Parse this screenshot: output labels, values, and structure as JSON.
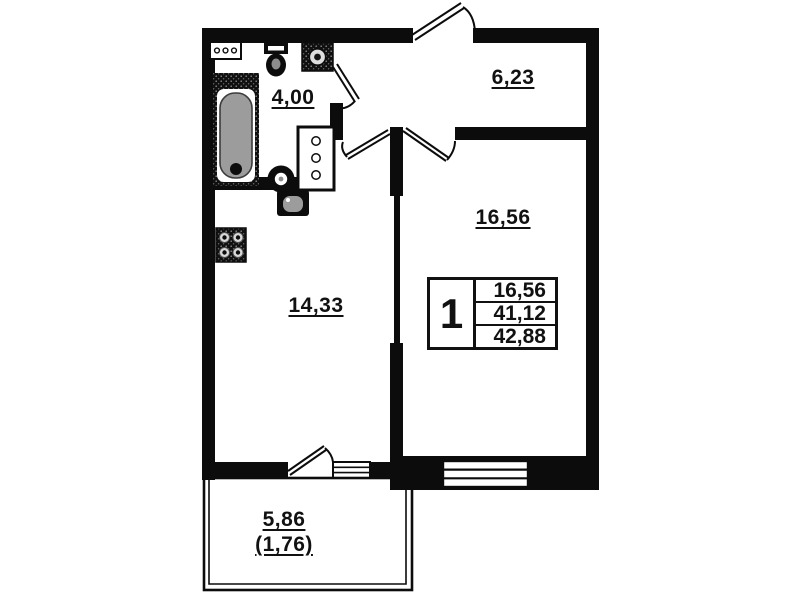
{
  "rooms": {
    "bathroom": {
      "label": "4,00"
    },
    "hallway": {
      "label": "6,23"
    },
    "living": {
      "label": "16,56"
    },
    "kitchen": {
      "label": "14,33"
    },
    "balcony": {
      "label": "5,86",
      "label_secondary": "(1,76)"
    }
  },
  "info_table": {
    "room_count": "1",
    "rows": [
      "16,56",
      "41,12",
      "42,88"
    ]
  },
  "fixtures": [
    "bathtub",
    "washbasin",
    "toilet",
    "washing-machine",
    "radiator",
    "ventilation-shaft",
    "kitchen-sink",
    "stove"
  ],
  "colors": {
    "wall": "#0c0c0c",
    "background": "#ffffff",
    "bathtub_fill": "#9c9c9c",
    "burner_fill": "#d9d9d9"
  }
}
